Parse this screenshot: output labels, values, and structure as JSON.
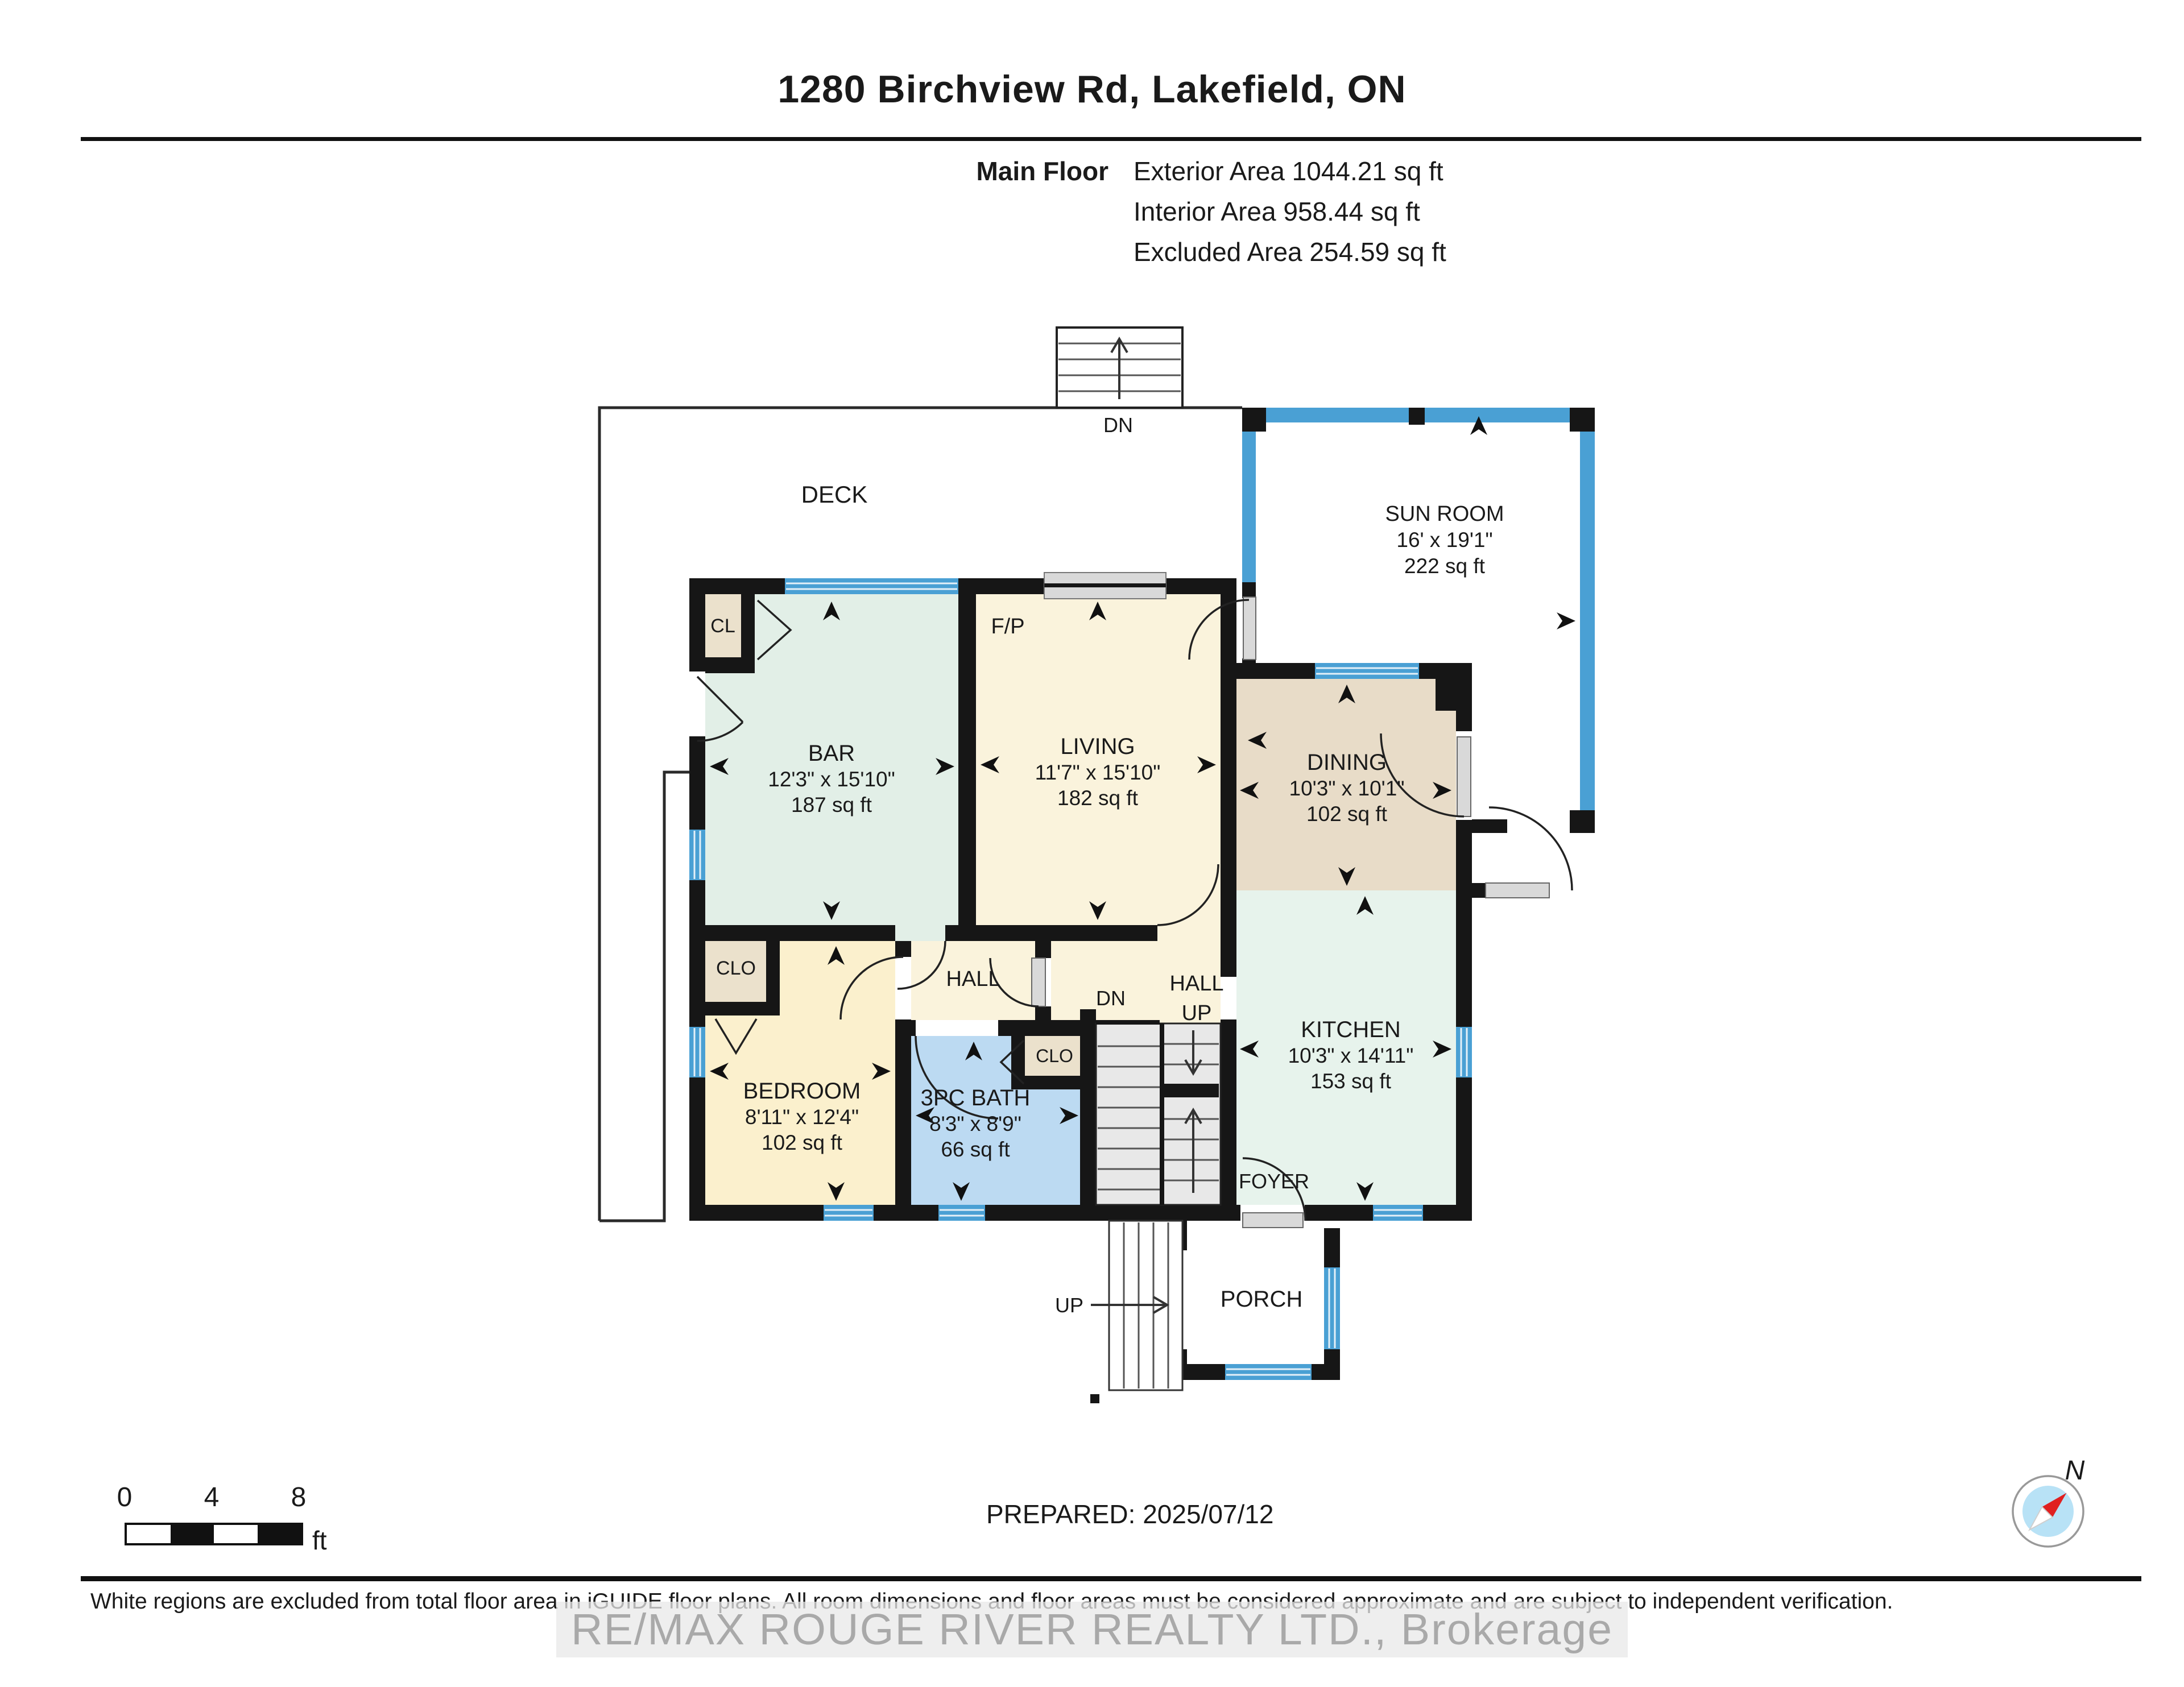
{
  "header": {
    "title": "1280 Birchview Rd, Lakefield, ON",
    "floor_label": "Main Floor",
    "stats": [
      "Exterior Area 1044.21 sq ft",
      "Interior Area 958.44 sq ft",
      "Excluded Area 254.59 sq ft"
    ]
  },
  "rooms": {
    "sun_room": {
      "name": "SUN ROOM",
      "dims": "16' x 19'1\"",
      "area": "222 sq ft"
    },
    "bar": {
      "name": "BAR",
      "dims": "12'3\" x 15'10\"",
      "area": "187 sq ft"
    },
    "living": {
      "name": "LIVING",
      "dims": "11'7\" x 15'10\"",
      "area": "182 sq ft"
    },
    "dining": {
      "name": "DINING",
      "dims": "10'3\" x 10'1\"",
      "area": "102 sq ft"
    },
    "kitchen": {
      "name": "KITCHEN",
      "dims": "10'3\" x 14'11\"",
      "area": "153 sq ft"
    },
    "bedroom": {
      "name": "BEDROOM",
      "dims": "8'11\" x 12'4\"",
      "area": "102 sq ft"
    },
    "bath": {
      "name": "3PC BATH",
      "dims": "8'3\" x 8'9\"",
      "area": "66 sq ft"
    }
  },
  "labels": {
    "deck": "DECK",
    "dn_deck": "DN",
    "cl": "CL",
    "clo_bedroom": "CLO",
    "clo_bath": "CLO",
    "fp": "F/P",
    "hall": "HALL",
    "hall_up_line1": "HALL",
    "hall_up_line2": "UP",
    "dn_stairs": "DN",
    "foyer": "FOYER",
    "porch": "PORCH",
    "up_stairs": "UP"
  },
  "scale_bar": {
    "tick0": "0",
    "tick4": "4",
    "tick8": "8",
    "unit": "ft"
  },
  "prepared": "PREPARED: 2025/07/12",
  "compass": {
    "north_label": "N"
  },
  "footer": {
    "disclaimer": "White regions are excluded from total floor area in iGUIDE floor plans. All room dimensions and floor areas must be considered approximate and are subject to independent verification.",
    "watermark": "RE/MAX ROUGE RIVER REALTY LTD.,  Brokerage"
  },
  "colors": {
    "wall": "#161616",
    "window_blue": "#4aa0d4",
    "bar_mint": "#e2efe7",
    "kitchen_mint": "#e7f3ec",
    "living_cream": "#faf3dc",
    "bedroom_cream": "#fbf0cd",
    "dining_tan": "#e8dcc8",
    "bath_blue": "#bcdaf2",
    "closet_beige": "#ebe1cc",
    "stair_gray": "#e8e8e8",
    "compass_red": "#e02020",
    "compass_blue": "#b8e2f6"
  }
}
